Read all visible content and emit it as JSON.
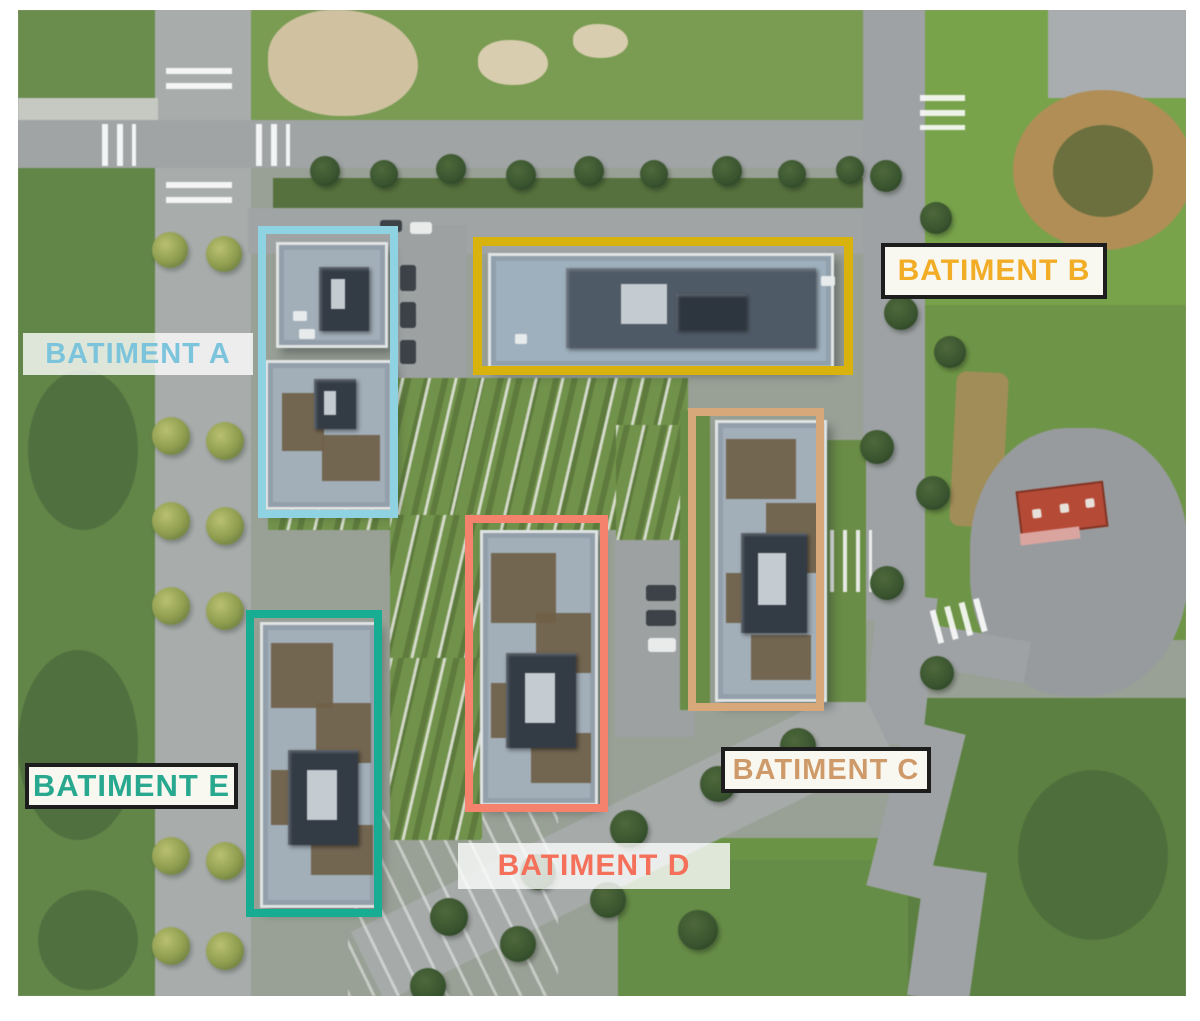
{
  "scene": {
    "kind": "annotated aerial satellite view",
    "subject": "residential block with five labeled buildings"
  },
  "annotations": [
    {
      "id": "a",
      "label": "BATIMENT A",
      "box_color": "#8FD2E2",
      "text_color": "#7CC4DC",
      "label_boxed": false
    },
    {
      "id": "b",
      "label": "BATIMENT B",
      "box_color": "#D8B30D",
      "text_color": "#F2AD26",
      "label_boxed": true
    },
    {
      "id": "c",
      "label": "BATIMENT C",
      "box_color": "#D7A97A",
      "text_color": "#CF9A69",
      "label_boxed": true
    },
    {
      "id": "d",
      "label": "BATIMENT D",
      "box_color": "#F5826C",
      "text_color": "#F4705A",
      "label_boxed": false
    },
    {
      "id": "e",
      "label": "BATIMENT E",
      "box_color": "#17AD92",
      "text_color": "#27A88F",
      "label_boxed": true
    }
  ]
}
